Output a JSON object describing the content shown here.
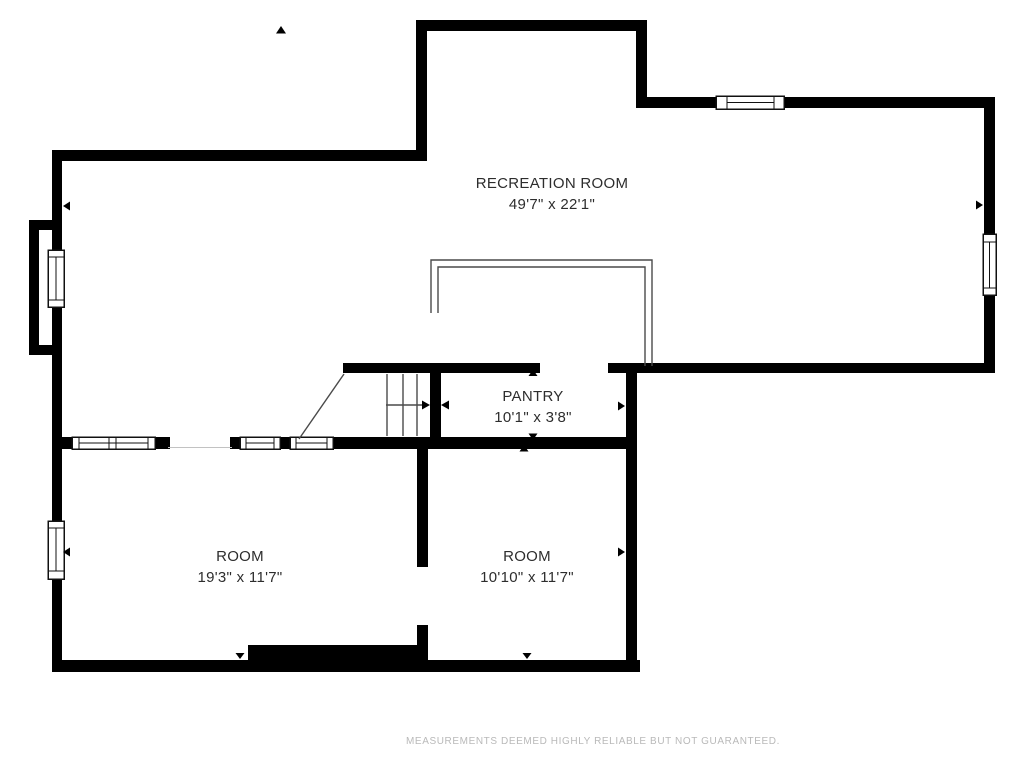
{
  "plan": {
    "type": "floor-plan",
    "footer_disclaimer": "MEASUREMENTS DEEMED HIGHLY RELIABLE BUT NOT GUARANTEED.",
    "colors": {
      "wall": "#000000",
      "label_text": "#2d2d2d",
      "thin_line": "#4a4a4a",
      "footer_text": "#b9b9b9",
      "background": "#ffffff"
    }
  },
  "rooms": [
    {
      "name": "RECREATION ROOM",
      "dims": "49'7\" x 22'1\""
    },
    {
      "name": "PANTRY",
      "dims": "10'1\" x 3'8\""
    },
    {
      "name": "ROOM",
      "dims": "19'3\" x 11'7\""
    },
    {
      "name": "ROOM",
      "dims": "10'10\" x 11'7\""
    }
  ]
}
